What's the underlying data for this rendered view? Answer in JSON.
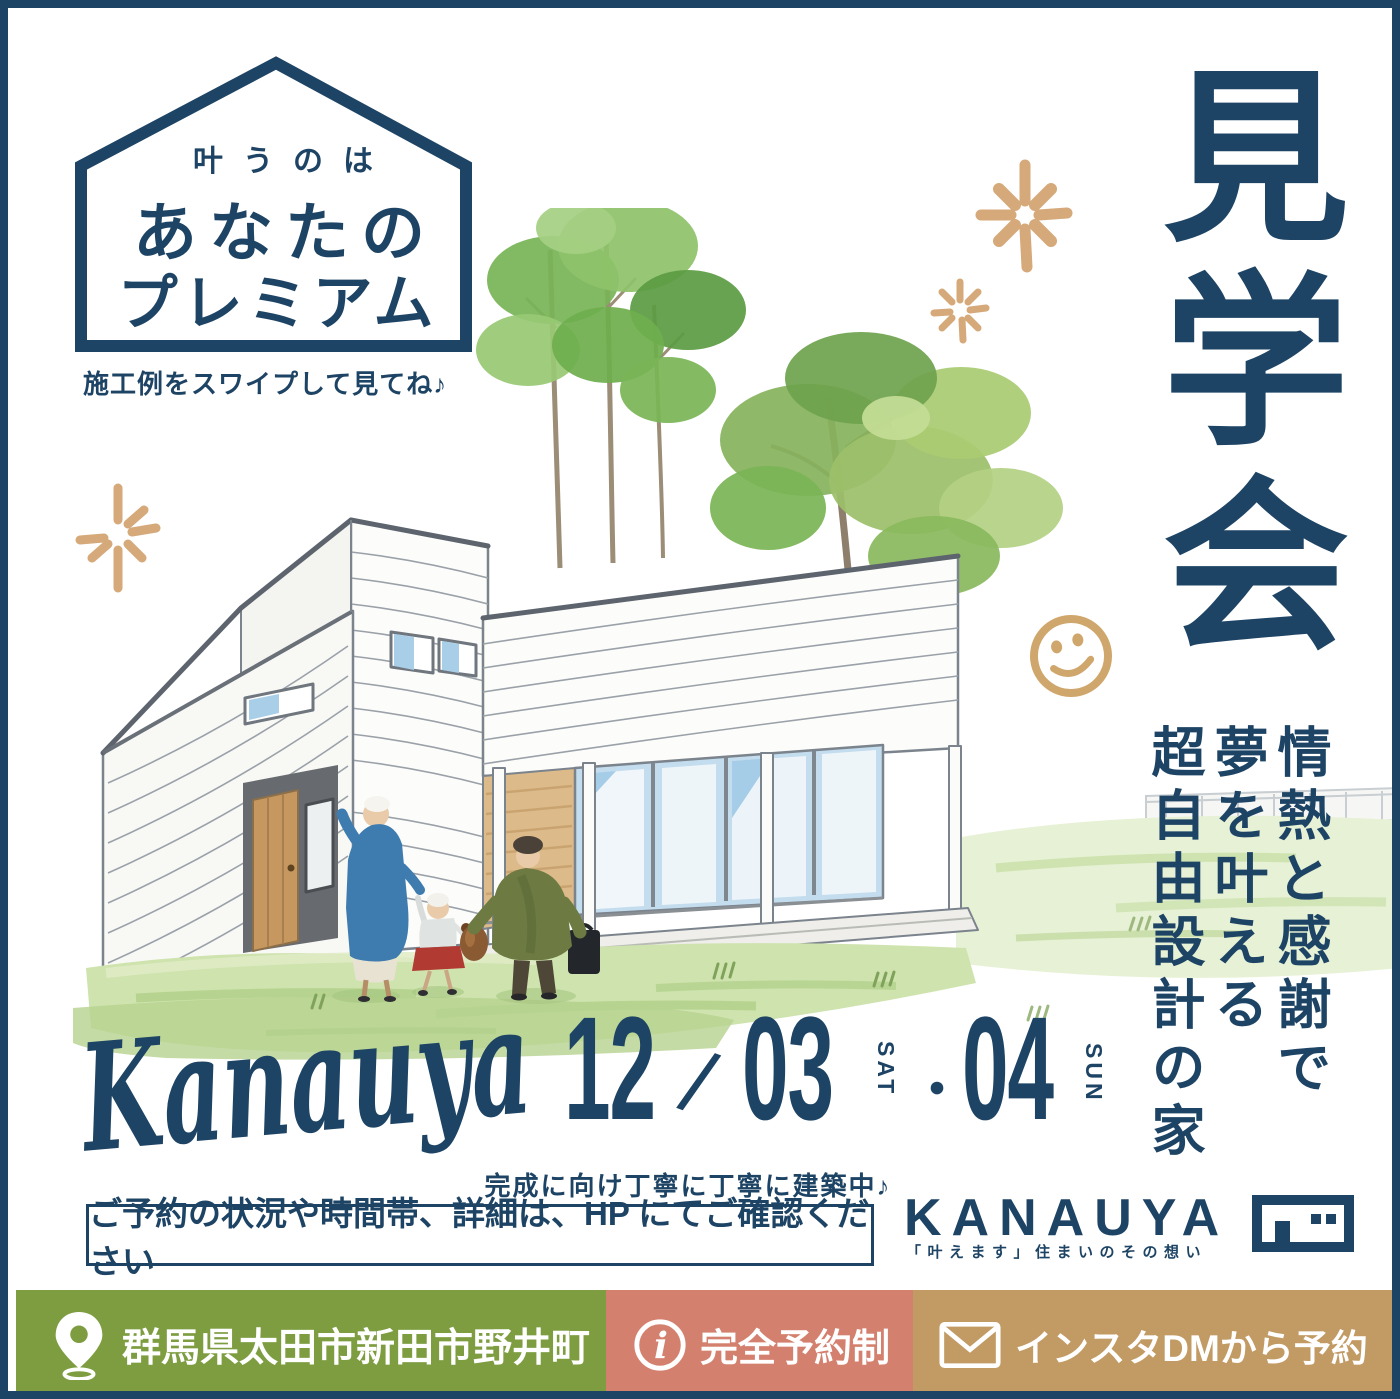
{
  "badge": {
    "top": "叶うのは",
    "middle": "あなたの",
    "bottom": "プレミアム"
  },
  "swipe_note": "施工例をスワイプして見てね♪",
  "event_title": "見学会",
  "slogan": {
    "line1": "情熱と感謝で",
    "line2": "夢を叶える",
    "line3": "超自由設計の家"
  },
  "signature": "Kanauya",
  "dates": {
    "month": "12",
    "slash": "/",
    "day1": "03",
    "day1_dow": "SAT",
    "separator": "・",
    "day2": "04",
    "day2_dow": "SUN"
  },
  "construction_note": "完成に向け丁寧に丁寧に建築中♪",
  "reservation_note": "ご予約の状況や時間帯、詳細は、HP にてご確認ください",
  "brand": {
    "logotype": "KANAUYA",
    "tagline": "「叶えます」住まいのその想い"
  },
  "footer": {
    "location": "群馬県太田市新田市野井町",
    "reservation": "完全予約制",
    "instagram": "インスタDMから予約"
  },
  "icons": {
    "badge_outline": "house-badge-outline-icon",
    "sparkle": "sparkle-icon",
    "smiley": "smiley-icon",
    "location": "location-pin-icon",
    "info": "info-icon",
    "mail": "envelope-icon",
    "logomark": "house-logomark-icon"
  },
  "colors": {
    "navy": "#1e4465",
    "accent_tan": "#d5a979",
    "bar_green": "#7d9d40",
    "bar_salmon": "#d4806e",
    "bar_tan": "#c29a63"
  }
}
